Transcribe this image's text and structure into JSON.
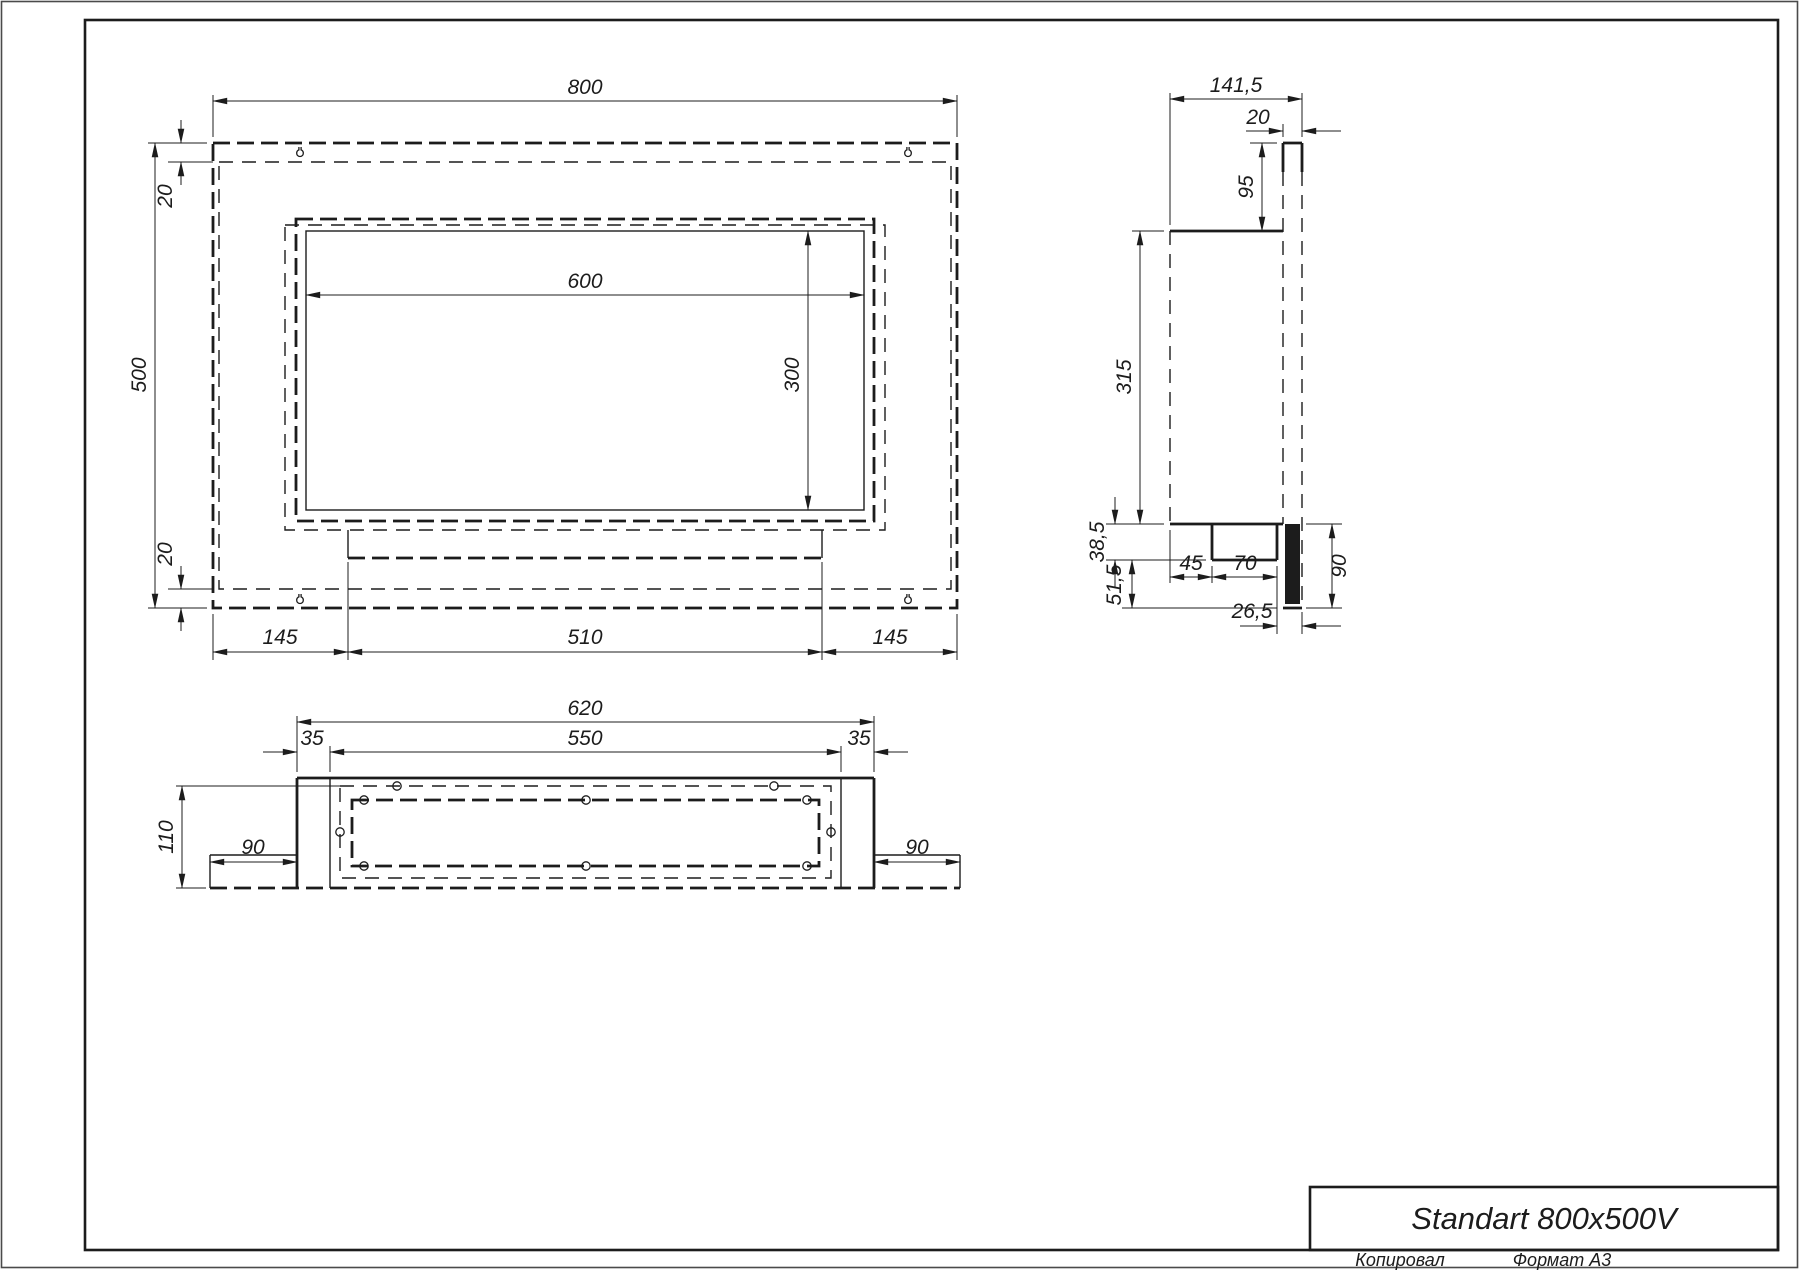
{
  "page": {
    "title": "Standart 800x500V",
    "footer_left": "Копировал",
    "footer_right": "Формат А3"
  },
  "colors": {
    "line": "#1c1c1c",
    "background": "#ffffff"
  },
  "views": {
    "front": {
      "dims": {
        "width": "800",
        "height": "500",
        "offset_top": "20",
        "offset_bottom": "20",
        "opening_width": "600",
        "opening_height": "300",
        "bottom_left": "145",
        "bottom_center": "510",
        "bottom_right": "145"
      }
    },
    "side": {
      "dims": {
        "depth": "141,5",
        "panel_thickness": "20",
        "top_to_body": "95",
        "body_height": "315",
        "tray_height": "38,5",
        "lower_height": "51,5",
        "tray_offset": "45",
        "tray_width": "70",
        "tray_to_edge": "26,5",
        "bottom_section": "90"
      }
    },
    "bottom": {
      "dims": {
        "width": "620",
        "opening": "550",
        "margin_left": "35",
        "margin_right": "35",
        "depth": "110",
        "wing_left": "90",
        "wing_right": "90"
      }
    }
  }
}
